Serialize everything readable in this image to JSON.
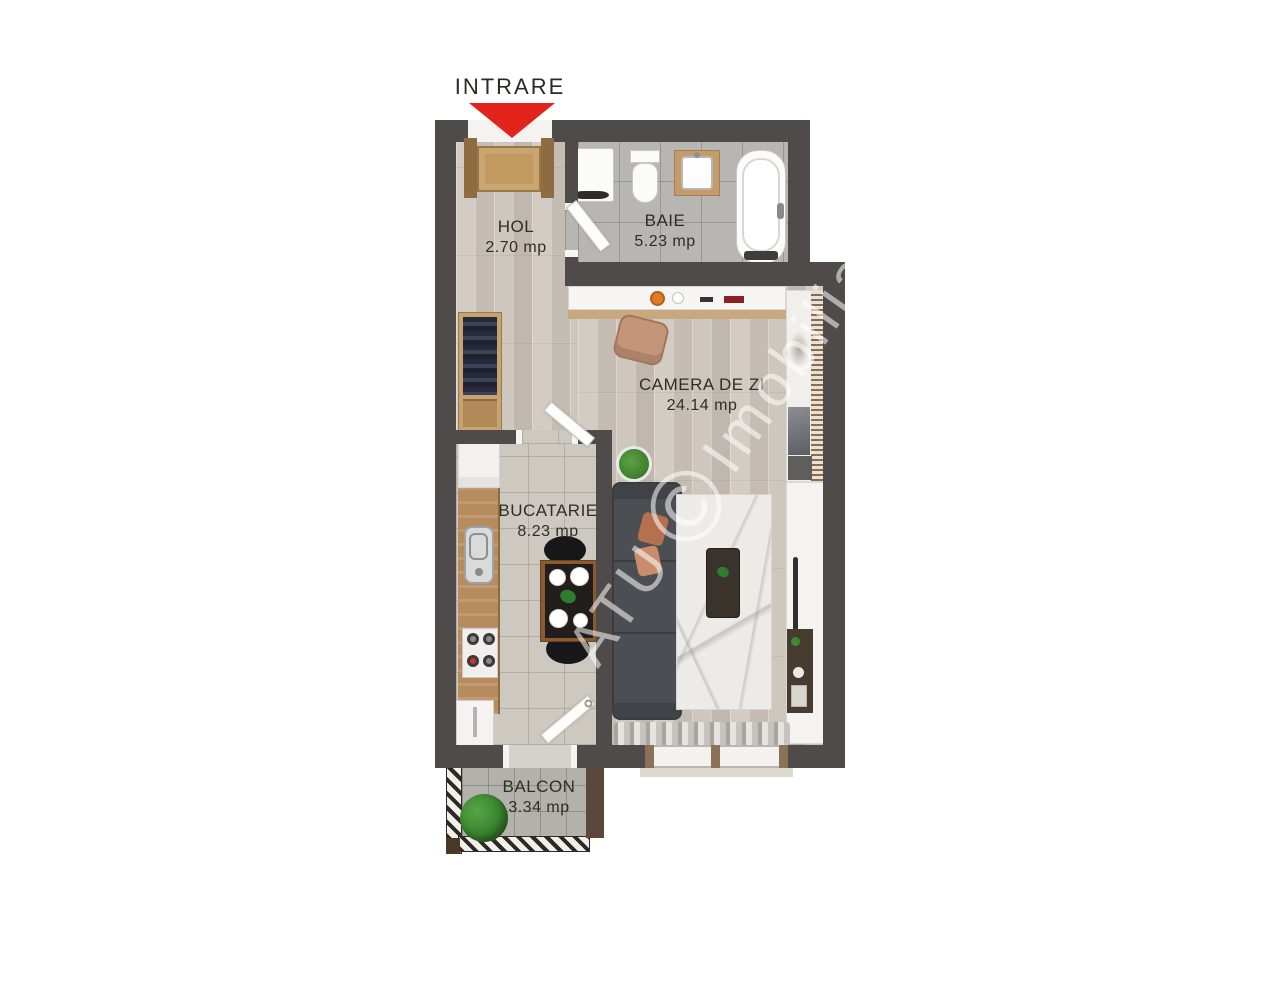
{
  "plan": {
    "entrance": {
      "label": "INTRARE"
    },
    "rooms": {
      "hol": {
        "name": "HOL",
        "area": "2.70 mp"
      },
      "baie": {
        "name": "BAIE",
        "area": "5.23 mp"
      },
      "camera_de_zi": {
        "name": "CAMERA DE ZI",
        "area": "24.14 mp"
      },
      "bucatarie": {
        "name": "BUCATARIE",
        "area": "8.23 mp"
      },
      "balcon": {
        "name": "BALCON",
        "area": "3.34 mp"
      }
    },
    "watermark": {
      "prefix": "ATU",
      "symbol": "©",
      "suffix": "Imobiliare"
    },
    "colors": {
      "wall": "#4f4b4b",
      "arrow_red": "#e2241d",
      "door_wood": "#c2995f",
      "wood_floor": "#cbc3ba",
      "bath_tile": "#b7b6b3",
      "kitchen_tile": "#cdc9c1",
      "balcony_tile": "#b3b1ac"
    }
  }
}
